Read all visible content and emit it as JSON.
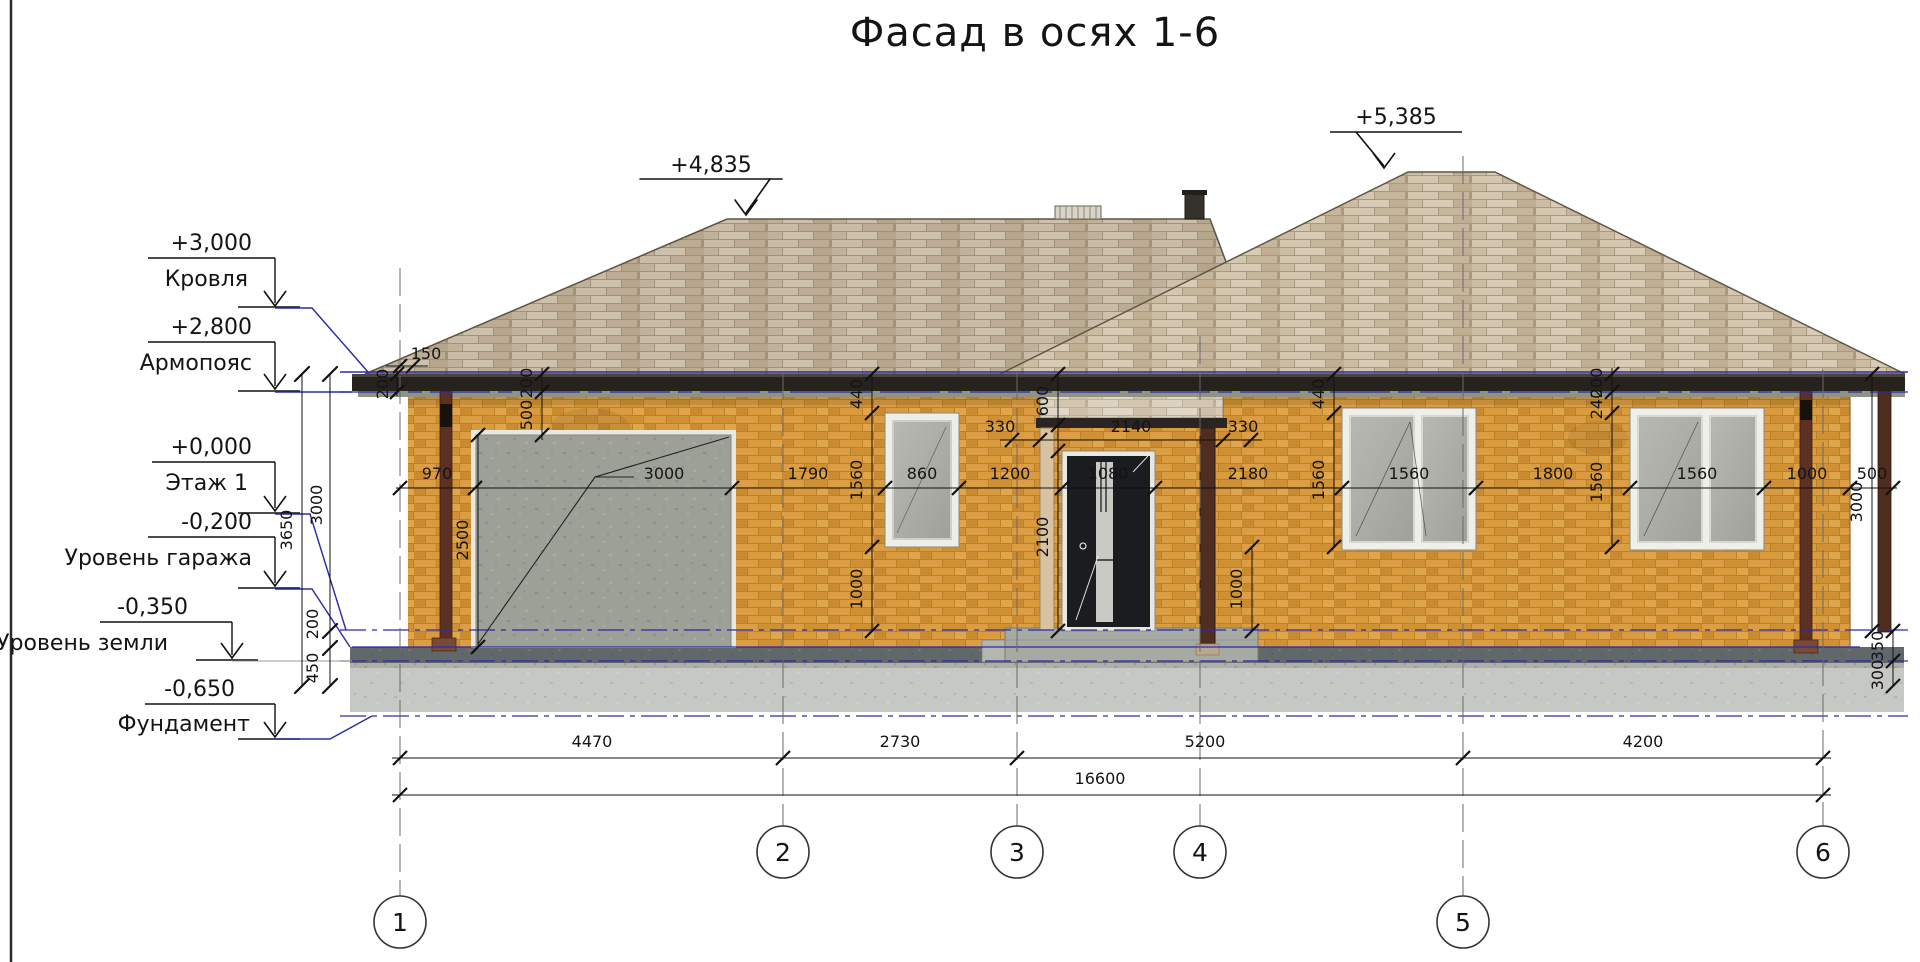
{
  "title": "Фасад в осях 1-6",
  "elevations": [
    {
      "value": "+3,000",
      "label": "Кровля"
    },
    {
      "value": "+2,800",
      "label": "Армопояс"
    },
    {
      "value": "+0,000",
      "label": "Этаж 1"
    },
    {
      "value": "-0,200",
      "label": "Уровень гаража"
    },
    {
      "value": "-0,350",
      "label": "Уровень земли"
    },
    {
      "value": "-0,650",
      "label": "Фундамент"
    }
  ],
  "roof_marks": {
    "left": "+4,835",
    "right": "+5,385"
  },
  "dims": {
    "main_row": [
      "970",
      "3000",
      "1790",
      "860",
      "1200",
      "1080",
      "2180",
      "1560",
      "1800",
      "1560",
      "1000",
      "500"
    ],
    "bottom_row": [
      "4470",
      "2730",
      "5200",
      "4200"
    ],
    "total": "16600",
    "left_col": {
      "h3650": "3650",
      "h3000": "3000",
      "h200": "200",
      "h450": "450"
    },
    "eave": {
      "d150": "150",
      "d200a": "200",
      "d200b": "200",
      "d500": "500"
    },
    "win1_col": [
      "440",
      "1560",
      "1000"
    ],
    "porch": {
      "c330l": "330",
      "c2140": "2140",
      "c330r": "330",
      "c600": "600",
      "c2100": "2100",
      "c2500": "2500"
    },
    "win3_col": [
      "440",
      "1560"
    ],
    "mid_col": [
      "200",
      "240",
      "1560"
    ],
    "sill_right": "1000",
    "right_col": {
      "v3000": "3000",
      "v350": "350",
      "v300": "300"
    }
  },
  "axes": [
    "1",
    "2",
    "3",
    "4",
    "5",
    "6"
  ],
  "colors": {
    "accent_blue": "#2b2ba8",
    "brick": "#d5973c",
    "roof": "#cdbfa7",
    "fascia": "#26221d"
  }
}
